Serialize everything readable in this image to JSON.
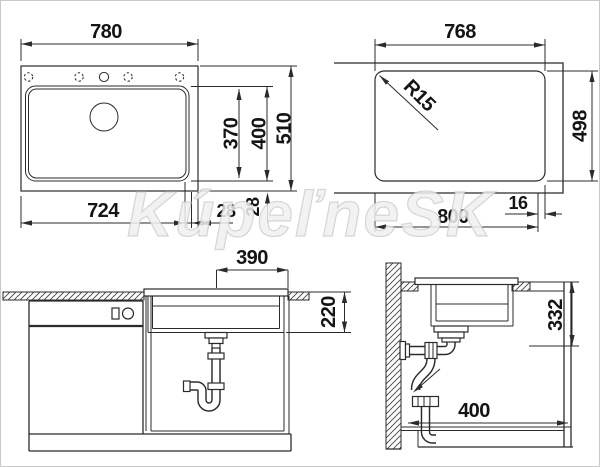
{
  "title": "Sink technical drawing with installation dimensions",
  "watermark": {
    "text": "KúpeľneSK"
  },
  "colors": {
    "line": "#2b2b2b",
    "text": "#141414",
    "watermark_stroke": "#bebebe",
    "background": "#ffffff",
    "border": "#c8c8c8"
  },
  "views": {
    "top": {
      "name": "sink top view",
      "dims": {
        "overall_width": "780",
        "bowl_width": "724",
        "right_ledge": "28",
        "outer_ledge": "28",
        "bowl_inner_depth": "370",
        "bowl_outer_depth": "400",
        "overall_depth": "510"
      }
    },
    "cutout": {
      "name": "worktop cutout view",
      "dims": {
        "cutout_width": "768",
        "cutout_depth": "498",
        "corner_radius": "R15",
        "cabinet_width": "800",
        "edge_offset": "16"
      }
    },
    "front": {
      "name": "front installation section",
      "dims": {
        "drain_to_edge": "390",
        "bowl_height": "220"
      }
    },
    "side": {
      "name": "side installation section",
      "dims": {
        "worktop_to_outlet": "332",
        "wall_clearance": "400"
      }
    }
  }
}
